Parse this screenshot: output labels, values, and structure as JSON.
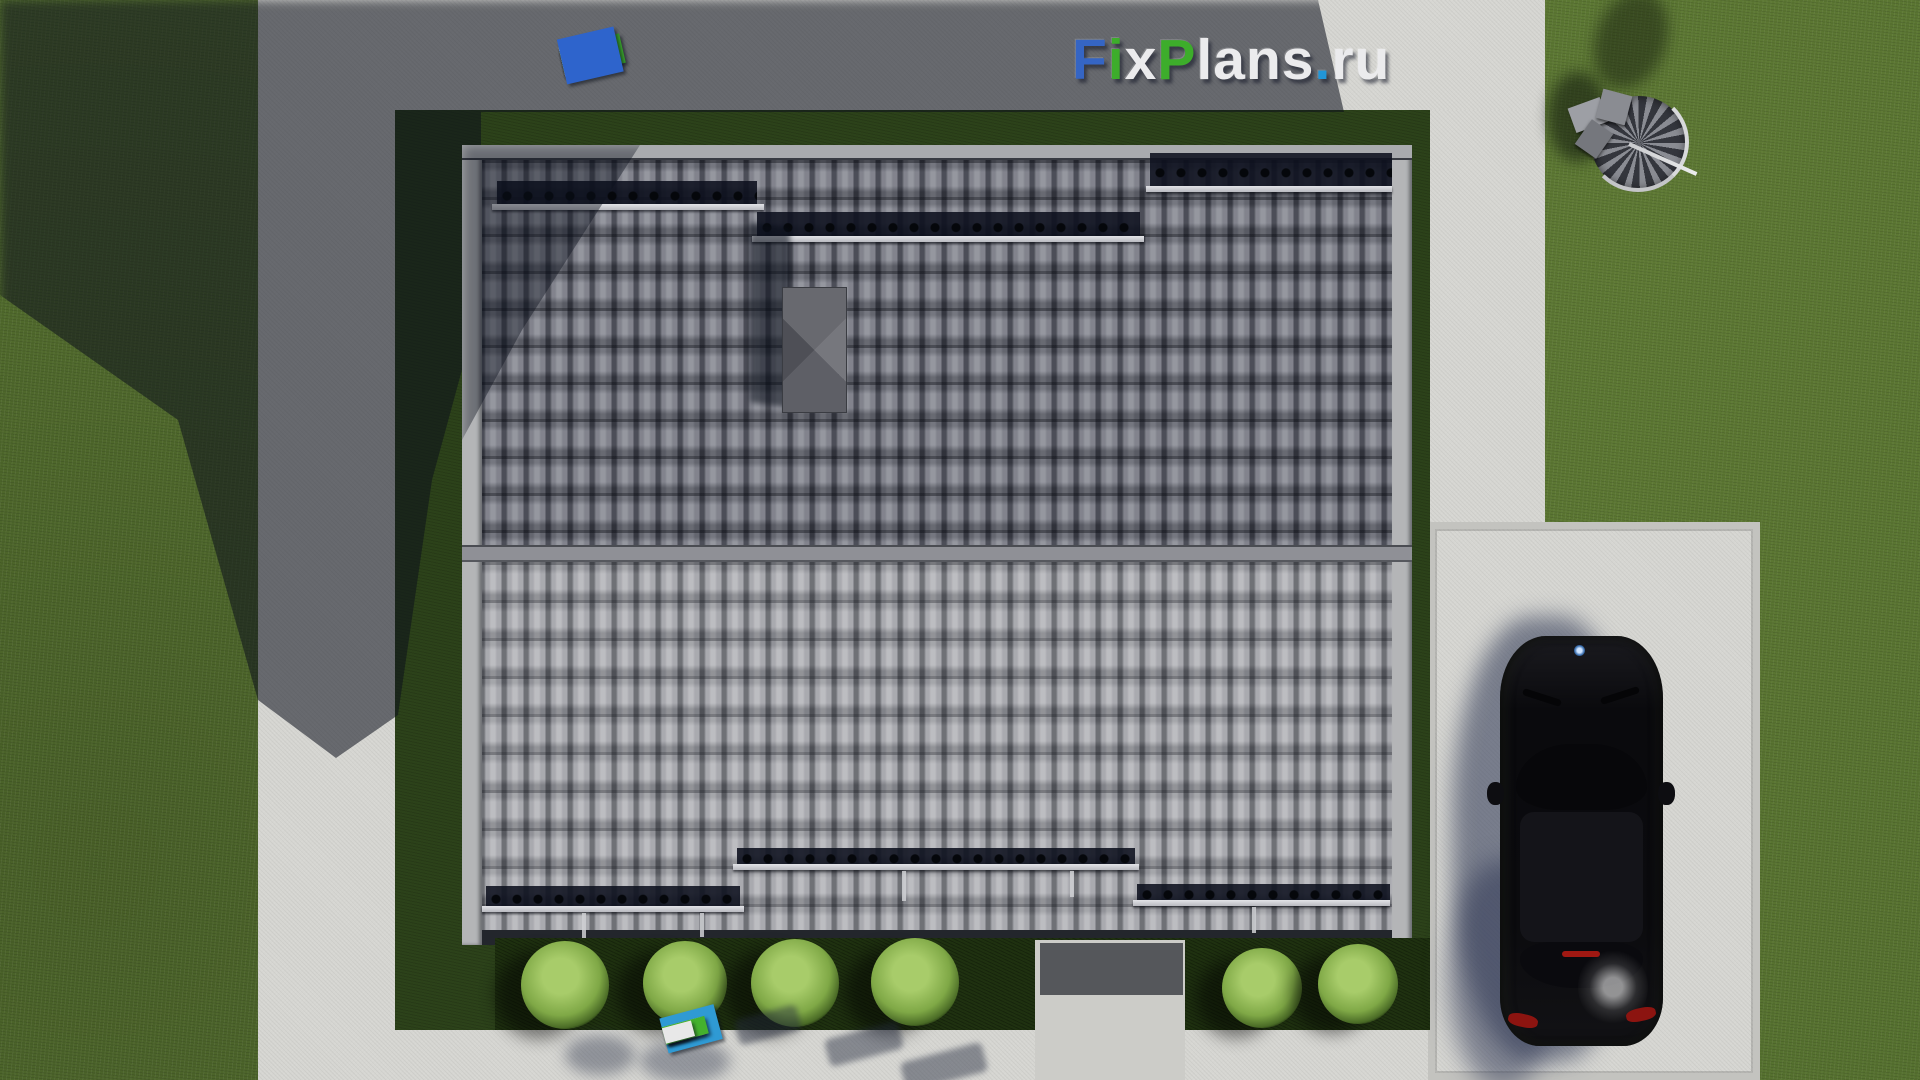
{
  "brand": {
    "text": "FixPlans.ru",
    "letters": [
      {
        "ch": "F",
        "color": "#3565c4"
      },
      {
        "ch": "i",
        "color": "#3dad2b"
      },
      {
        "ch": "x",
        "color": "#ebebed"
      },
      {
        "ch": "P",
        "color": "#3dad2b"
      },
      {
        "ch": "l",
        "color": "#ebebed"
      },
      {
        "ch": "a",
        "color": "#ebebed"
      },
      {
        "ch": "n",
        "color": "#ebebed"
      },
      {
        "ch": "s",
        "color": "#ebebed"
      },
      {
        "ch": ".",
        "color": "#2196d8"
      },
      {
        "ch": "r",
        "color": "#ebebed"
      },
      {
        "ch": "u",
        "color": "#ebebed"
      }
    ]
  },
  "watermark_strip_top": {
    "blocks": [
      {
        "color": "#e3e4e6",
        "w": 40,
        "h": 24,
        "gap": 6
      },
      {
        "color": "#e3e4e6",
        "w": 26,
        "h": 22,
        "gap": 4
      },
      {
        "color": "#2856c0",
        "w": 26,
        "h": 26,
        "gap": 10
      },
      {
        "color": "#e3e4e6",
        "w": 52,
        "h": 26,
        "gap": 6
      },
      {
        "color": "#e3e4e6",
        "w": 44,
        "h": 24,
        "gap": 4
      },
      {
        "color": "#e3e4e6",
        "w": 56,
        "h": 28,
        "gap": 8
      },
      {
        "color": "#e3e4e6",
        "w": 26,
        "h": 26,
        "gap": 8
      },
      {
        "color": "#3aa42c",
        "w": 62,
        "h": 30,
        "gap": 6
      },
      {
        "color": "#e3e4e6",
        "w": 36,
        "h": 30,
        "gap": 4
      },
      {
        "color": "#e3e4e6",
        "w": 34,
        "h": 28,
        "gap": 10
      },
      {
        "color": "#3aa42c",
        "w": 24,
        "h": 22,
        "gap": 6
      },
      {
        "color": "#2e64cc",
        "w": 58,
        "h": 46,
        "gap": 0
      }
    ]
  },
  "watermark_strip_bottom": {
    "blocks": [
      {
        "color": "#2f9ad4",
        "w": 56,
        "h": 36,
        "gap": 10
      },
      {
        "color": "#44b12e",
        "w": 22,
        "h": 16,
        "gap": 6
      },
      {
        "color": "#e8e8e8",
        "w": 40,
        "h": 18,
        "gap": 4
      },
      {
        "color": "#e8e8e8",
        "w": 22,
        "h": 14,
        "gap": 8
      },
      {
        "color": "#44b12e",
        "w": 44,
        "h": 18,
        "gap": 6
      },
      {
        "color": "#e8e8e8",
        "w": 30,
        "h": 16,
        "gap": 0
      }
    ]
  },
  "scene_colors": {
    "grass_lit": "#55702f",
    "grass_yard": "#2c421a",
    "hedge": "#1f3110",
    "concrete_lit": "#d6d6d2",
    "concrete_shadow": "#5c6274",
    "roof_upper": "#707179",
    "roof_lower": "#9b9ca1",
    "ridge": "#8f9096",
    "snow_guard_band": "#10141e",
    "car_body": "#0a0a0d",
    "taillight_red": "#8c1410"
  }
}
